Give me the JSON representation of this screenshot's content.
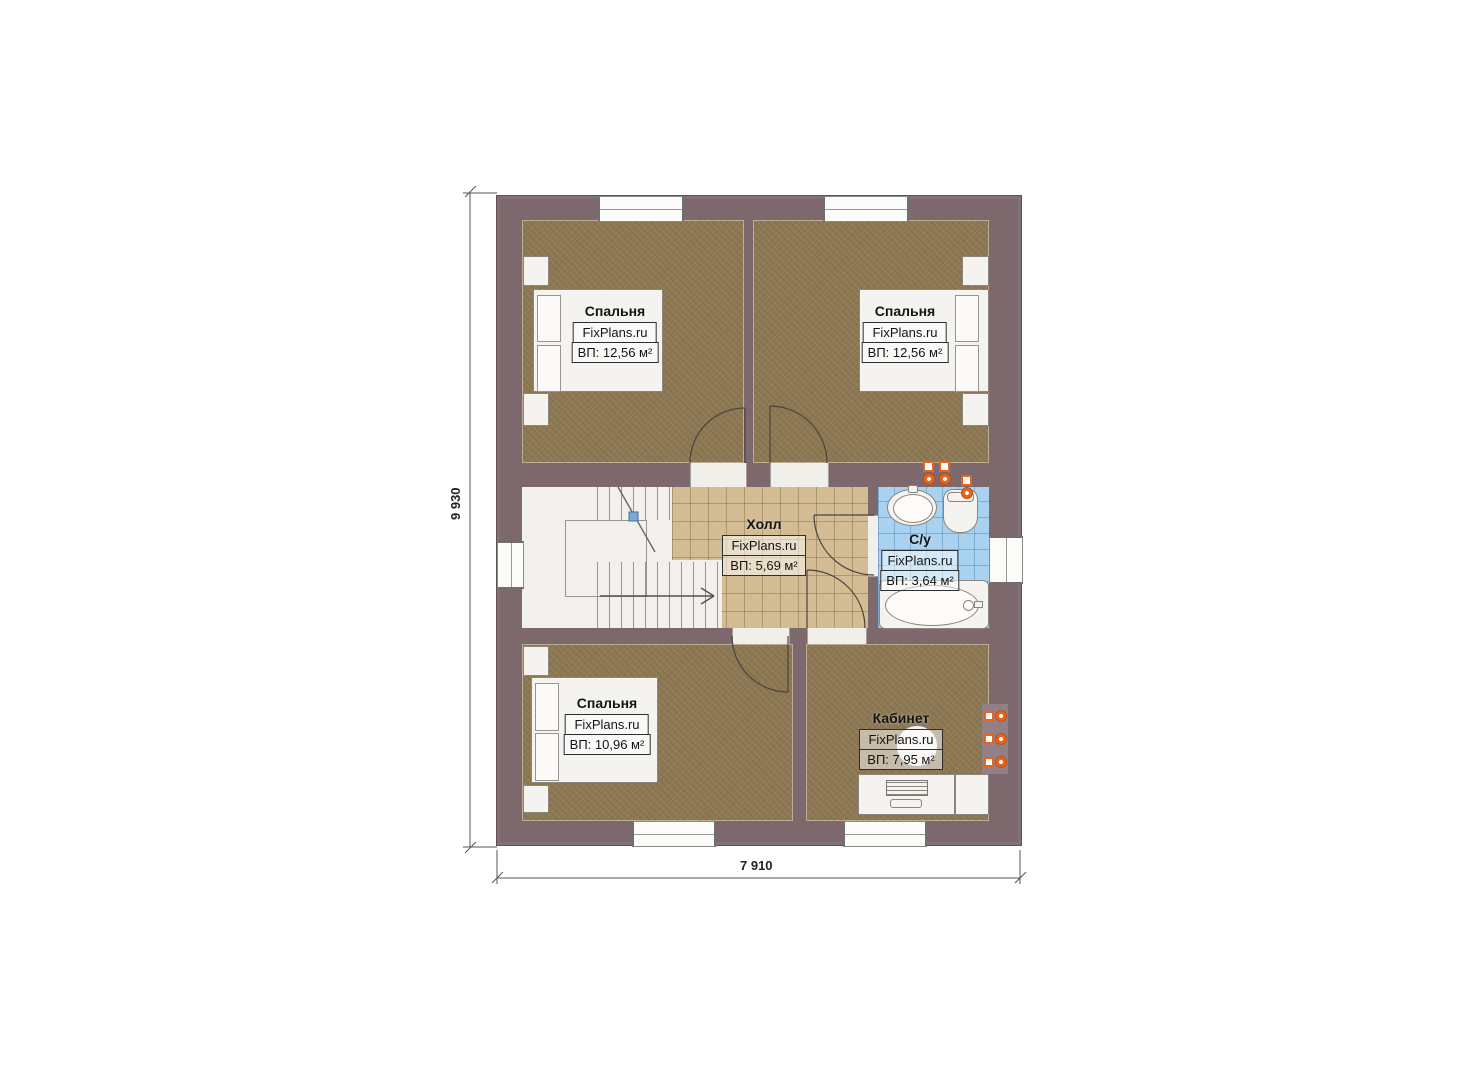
{
  "plan": {
    "brand": "FixPlans.ru",
    "rooms": [
      {
        "id": "bedroom-top-left",
        "name": "Спальня",
        "brand": "FixPlans.ru",
        "area": "ВП: 12,56 м²"
      },
      {
        "id": "bedroom-top-right",
        "name": "Спальня",
        "brand": "FixPlans.ru",
        "area": "ВП: 12,56 м²"
      },
      {
        "id": "hall",
        "name": "Холл",
        "brand": "FixPlans.ru",
        "area": "ВП: 5,69 м²"
      },
      {
        "id": "bathroom",
        "name": "С/у",
        "brand": "FixPlans.ru",
        "area": "ВП: 3,64 м²"
      },
      {
        "id": "bedroom-bottom-left",
        "name": "Спальня",
        "brand": "FixPlans.ru",
        "area": "ВП: 10,96 м²"
      },
      {
        "id": "office",
        "name": "Кабинет",
        "brand": "FixPlans.ru",
        "area": "ВП: 7,95 м²"
      }
    ],
    "dimensions": {
      "height_mm": "9 930",
      "width_mm": "7 910"
    },
    "colors": {
      "wall": "#7d696d",
      "bedroom_floor": "#8e7954",
      "hall_floor": "#d3bc93",
      "bath_floor": "#a9d2f0",
      "accent_orange": "#e8641c"
    }
  }
}
